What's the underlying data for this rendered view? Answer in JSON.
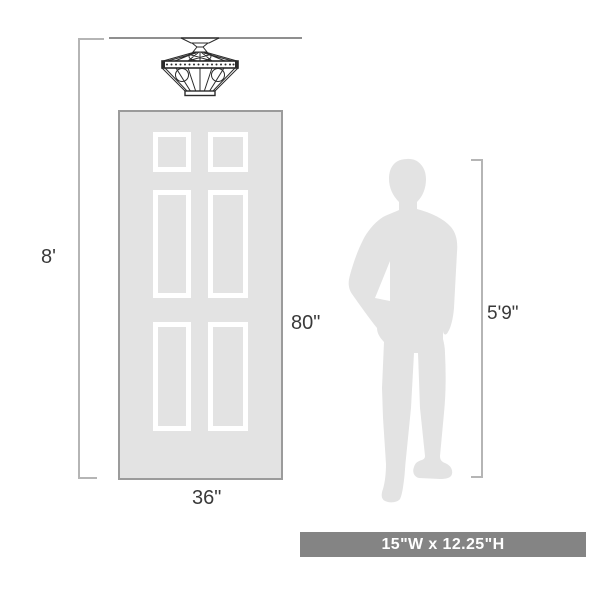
{
  "diagram": {
    "measurements": {
      "room_height": "8'",
      "door_height": "80\"",
      "door_width": "36\"",
      "person_height": "5'9\""
    },
    "banner": {
      "text": "15\"W x 12.25\"H"
    },
    "illustrations": {
      "fixture": "semi-flush-mount-ceiling-light",
      "door": "six-panel-door",
      "person": "standing-man-silhouette"
    },
    "colors": {
      "background": "#ffffff",
      "silhouette_fill": "#e3e3e3",
      "door_fill": "#e3e3e3",
      "door_border": "#9b9b9b",
      "panel_outline": "#ffffff",
      "dimension_line": "#b5b5b5",
      "ceiling_line": "#8f8f8f",
      "label_text": "#3a3a3a",
      "banner_bg": "#848484",
      "banner_text": "#ffffff",
      "fixture_line": "#2b2b2b"
    }
  }
}
